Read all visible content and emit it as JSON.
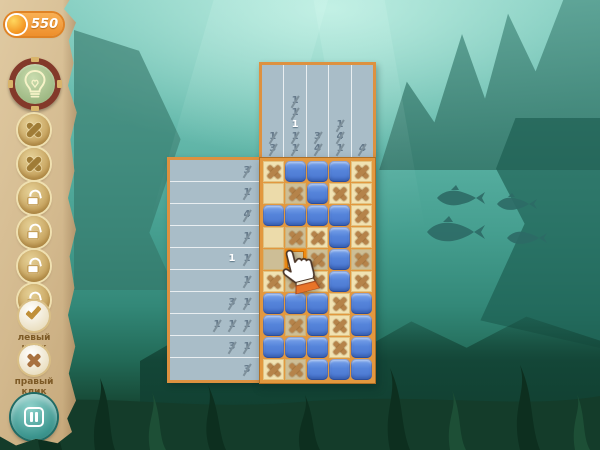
{
  "sidebar": {
    "coins": "550",
    "powerups": [
      {
        "icon": "x"
      },
      {
        "icon": "x"
      },
      {
        "icon": "lock"
      },
      {
        "icon": "lock"
      },
      {
        "icon": "lock"
      },
      {
        "icon": "lock"
      }
    ],
    "left_click_label": "левый клик",
    "right_click_label": "правый клик"
  },
  "board": {
    "col_clues": [
      [
        {
          "v": "1",
          "done": true
        },
        {
          "v": "3",
          "done": true
        }
      ],
      [
        {
          "v": "1",
          "done": true
        },
        {
          "v": "1",
          "done": true
        },
        {
          "v": "1",
          "done": false
        },
        {
          "v": "1",
          "done": true
        },
        {
          "v": "1",
          "done": true
        }
      ],
      [
        {
          "v": "3",
          "done": true
        },
        {
          "v": "4",
          "done": true
        }
      ],
      [
        {
          "v": "1",
          "done": true
        },
        {
          "v": "4",
          "done": true
        },
        {
          "v": "1",
          "done": true
        }
      ],
      [
        {
          "v": "4",
          "done": true
        }
      ]
    ],
    "row_clues": [
      [
        {
          "v": "3",
          "done": true
        }
      ],
      [
        {
          "v": "1",
          "done": true
        }
      ],
      [
        {
          "v": "4",
          "done": true
        }
      ],
      [
        {
          "v": "1",
          "done": true
        }
      ],
      [
        {
          "v": "1",
          "done": false
        },
        {
          "v": "1",
          "done": true
        }
      ],
      [
        {
          "v": "1",
          "done": true
        }
      ],
      [
        {
          "v": "3",
          "done": true
        },
        {
          "v": "1",
          "done": true
        }
      ],
      [
        {
          "v": "1",
          "done": true
        },
        {
          "v": "1",
          "done": true
        },
        {
          "v": "1",
          "done": true
        }
      ],
      [
        {
          "v": "3",
          "done": true
        },
        {
          "v": "1",
          "done": true
        }
      ],
      [
        {
          "v": "3",
          "done": true
        }
      ]
    ],
    "cells": [
      [
        "x",
        "b",
        "b",
        "b",
        "x"
      ],
      [
        "e",
        "x",
        "b",
        "x",
        "x"
      ],
      [
        "b",
        "b",
        "b",
        "b",
        "x"
      ],
      [
        "e",
        "x",
        "x",
        "b",
        "x"
      ],
      [
        "e",
        "e",
        "x",
        "b",
        "x"
      ],
      [
        "x",
        "x",
        "x",
        "b",
        "x"
      ],
      [
        "b",
        "b",
        "b",
        "x",
        "b"
      ],
      [
        "b",
        "x",
        "b",
        "x",
        "b"
      ],
      [
        "b",
        "b",
        "b",
        "x",
        "b"
      ],
      [
        "x",
        "x",
        "b",
        "b",
        "b"
      ]
    ],
    "hover": {
      "row": 4,
      "col": 1
    }
  },
  "colors": {
    "accent_orange": "#ef8f2e",
    "board_frame": "#e2983f",
    "cell_blue": "#4a76cf",
    "cross_brown": "#b5834a",
    "clue_panel": "#a9bdc8",
    "parchment": "#d3b98e",
    "pause_teal": "#3b948d",
    "hint_ring": "#83392a"
  }
}
